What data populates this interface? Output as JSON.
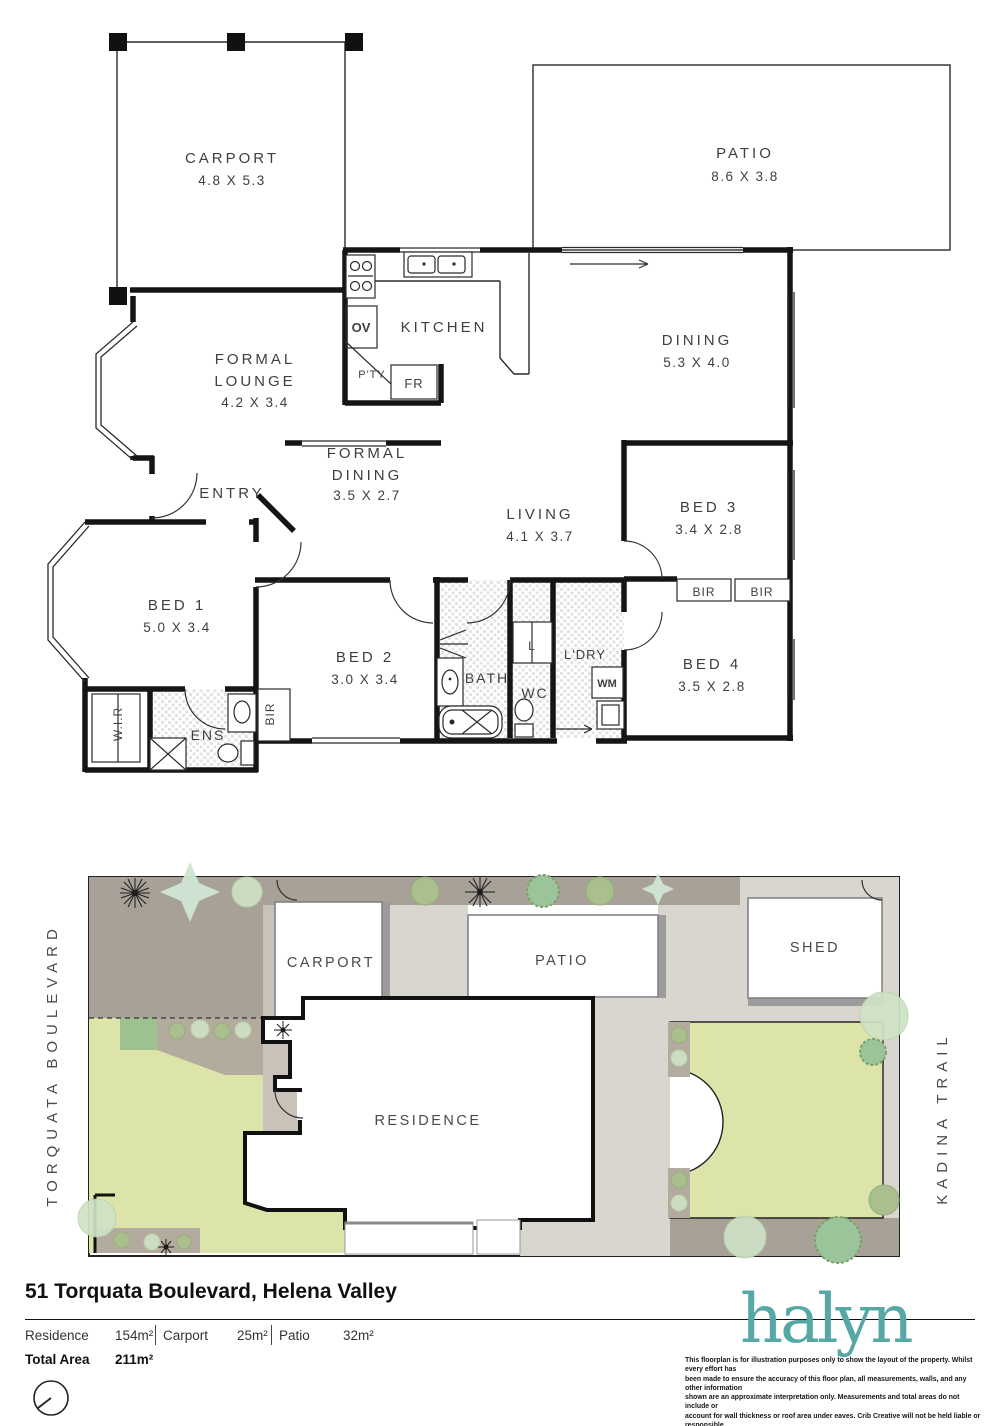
{
  "floorplan": {
    "carport": {
      "label": "CARPORT",
      "dims": "4.8 X 5.3"
    },
    "patio": {
      "label": "PATIO",
      "dims": "8.6 X 3.8"
    },
    "kitchen": {
      "label": "KITCHEN"
    },
    "dining": {
      "label": "DINING",
      "dims": "5.3 X 4.0"
    },
    "formal_lounge": {
      "l1": "FORMAL",
      "l2": "LOUNGE",
      "dims": "4.2 X 3.4"
    },
    "formal_dining": {
      "l1": "FORMAL",
      "l2": "DINING",
      "dims": "3.5 X 2.7"
    },
    "entry": {
      "label": "ENTRY"
    },
    "living": {
      "label": "LIVING",
      "dims": "4.1 X 3.7"
    },
    "bed1": {
      "label": "BED 1",
      "dims": "5.0 X 3.4"
    },
    "bed2": {
      "label": "BED 2",
      "dims": "3.0 X 3.4"
    },
    "bed3": {
      "label": "BED 3",
      "dims": "3.4 X 2.8"
    },
    "bed4": {
      "label": "BED 4",
      "dims": "3.5 X 2.8"
    },
    "bath": {
      "label": "BATH"
    },
    "wc": {
      "label": "WC"
    },
    "ens": {
      "label": "ENS"
    },
    "wir": {
      "label": "W.I.R"
    },
    "ldry": {
      "label": "L'DRY"
    },
    "linen": {
      "label": "L"
    },
    "bir": "BIR",
    "ov": "OV",
    "pty": "P'TY",
    "fr": "FR",
    "wm": "WM"
  },
  "siteplan": {
    "street_left": "TORQUATA BOULEVARD",
    "street_right": "KADINA TRAIL",
    "carport": "CARPORT",
    "patio": "PATIO",
    "shed": "SHED",
    "residence": "RESIDENCE"
  },
  "footer": {
    "address": "51 Torquata Boulevard, Helena Valley",
    "areas": [
      {
        "label": "Residence",
        "value": "154m²"
      },
      {
        "label": "Carport",
        "value": "25m²"
      },
      {
        "label": "Patio",
        "value": "32m²"
      }
    ],
    "total_label": "Total Area",
    "total_value": "211m²",
    "logo": "halyn",
    "disclaimer_lines": [
      "This floorplan is for illustration purposes only to show the layout of the property. Whilst every effort has",
      "been made to ensure the accuracy of this floor plan, all measurements, walls, and any other information",
      "shown are an approximate interpretation only. Measurements and total areas do not include or",
      "account for wall thickness or roof area under eaves. Crib Creative will not be held liable or responsible",
      "for any error, omission, misrepresentation or use of any information shown on the final floor plan.",
      "Not to be used for any other purpose.",
      "www.cribcreative.com.au"
    ]
  },
  "colors": {
    "teal": "#55a8a5",
    "lawn": "#dde4a9",
    "taupe": "#a8a198",
    "path": "#d9d6d0",
    "bedpath": "#c9c2b8",
    "garden": "#b4ab9f",
    "shrub": "#9ec28f",
    "wall": "#151515"
  }
}
